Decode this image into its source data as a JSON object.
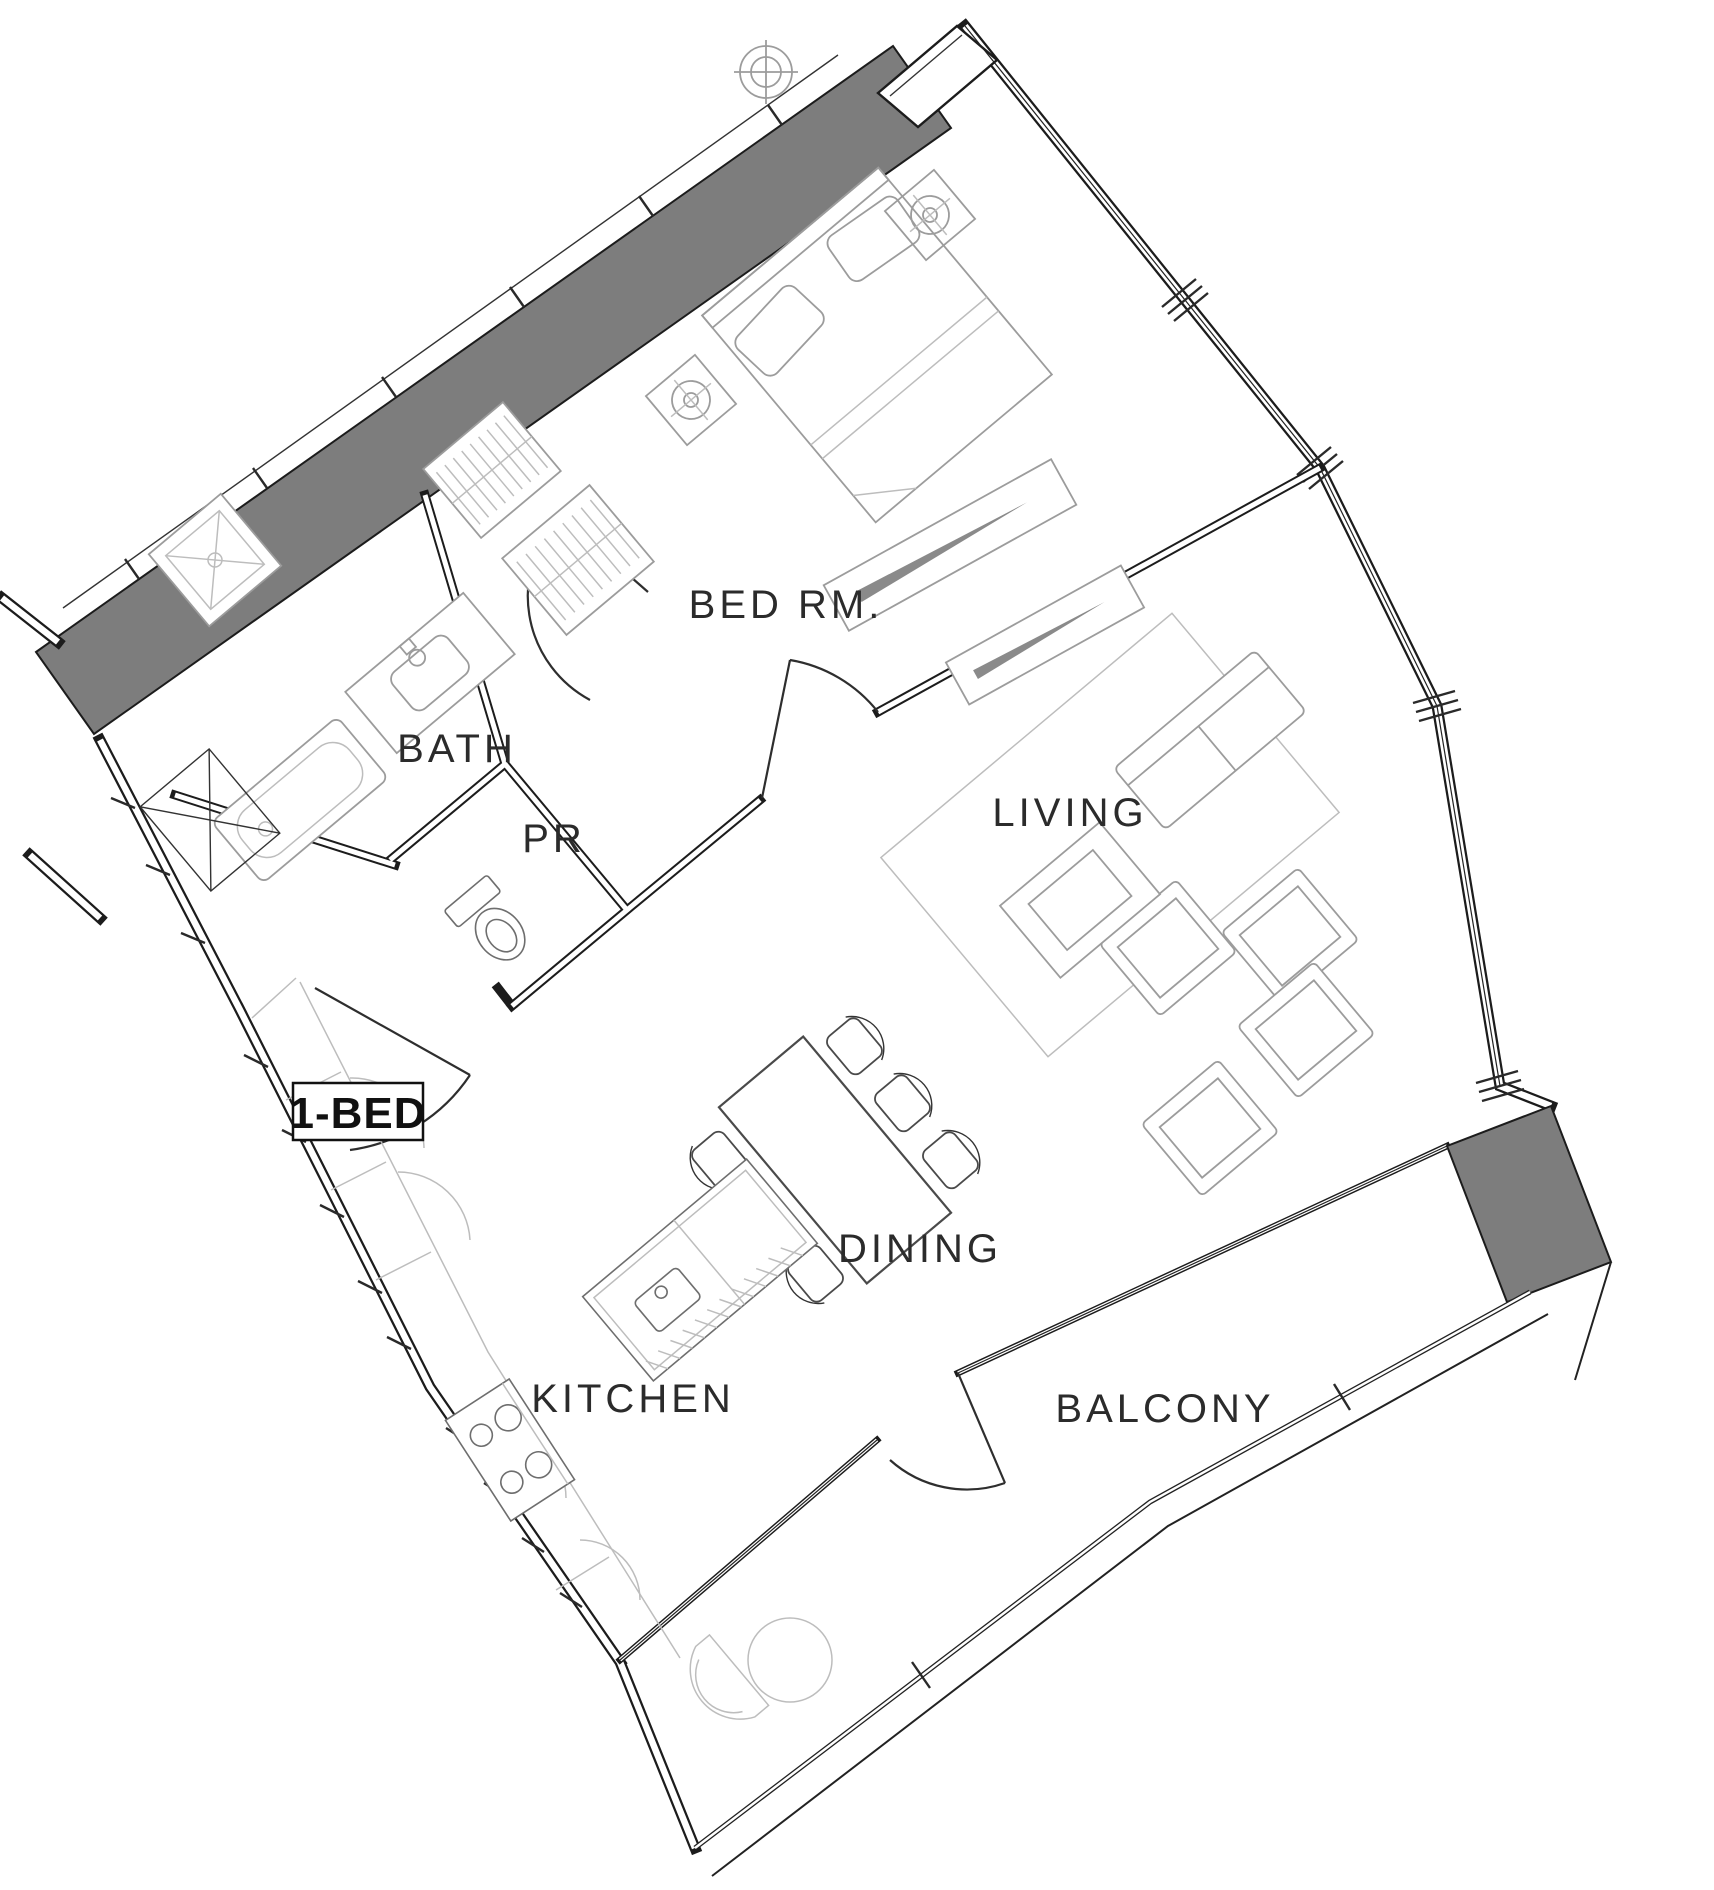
{
  "meta": {
    "type": "apartment-floor-plan"
  },
  "unit": {
    "label": "1-BED"
  },
  "rooms": [
    {
      "id": "bedroom",
      "label": "BED RM."
    },
    {
      "id": "bath",
      "label": "BATH"
    },
    {
      "id": "powder",
      "label": "PR"
    },
    {
      "id": "living",
      "label": "LIVING"
    },
    {
      "id": "dining",
      "label": "DINING"
    },
    {
      "id": "kitchen",
      "label": "KITCHEN"
    },
    {
      "id": "balcony",
      "label": "BALCONY"
    }
  ],
  "colors": {
    "wall": "#1c1c1c",
    "poche": "#7d7d7d",
    "furniture": "#9c9c9c",
    "furniture_light": "#bdbdbd",
    "background": "#ffffff",
    "label": "#2b2b2b"
  }
}
